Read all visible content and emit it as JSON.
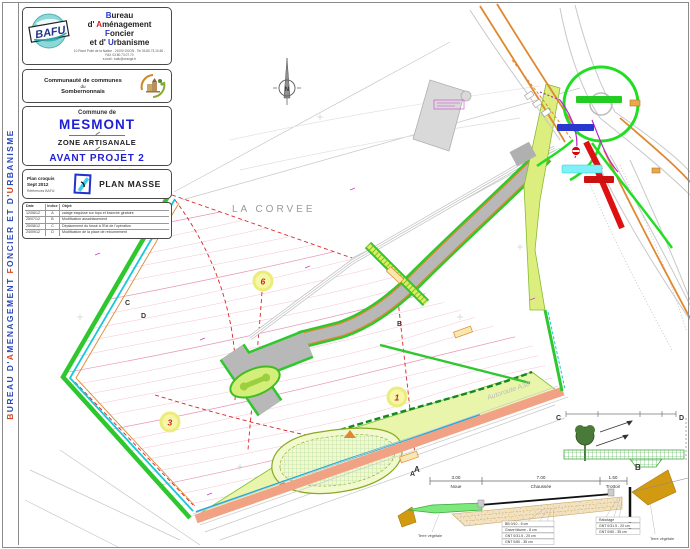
{
  "colors": {
    "brand_blue": "#2233cc",
    "accent_red": "#cc2222",
    "site_green": "#2ec82e",
    "cyan_line": "#18c8d8",
    "salmon_road": "#f2a284",
    "contour_pink": "#f2b6c6",
    "title_blue": "#1f1fd6"
  },
  "sidebar": {
    "parts": [
      {
        "t": "B",
        "c": "sr"
      },
      {
        "t": "UREAU  D'",
        "c": "sb"
      },
      {
        "t": "A",
        "c": "sr"
      },
      {
        "t": "MENAGEMENT  ",
        "c": "sb"
      },
      {
        "t": "F",
        "c": "sr"
      },
      {
        "t": "ONCIER  ET  D'",
        "c": "sb"
      },
      {
        "t": "U",
        "c": "sr"
      },
      {
        "t": "RBANISME",
        "c": "sb"
      }
    ]
  },
  "firm": {
    "logo_text": "BAFU",
    "line1": [
      {
        "t": "B",
        "c": "blue"
      },
      {
        "t": "ureau",
        "c": "k"
      }
    ],
    "line2": [
      {
        "t": "d' ",
        "c": "k"
      },
      {
        "t": "A",
        "c": "red"
      },
      {
        "t": "ménagement",
        "c": "k"
      }
    ],
    "line3": [
      {
        "t": "F",
        "c": "blue"
      },
      {
        "t": "oncier",
        "c": "k"
      }
    ],
    "line4": [
      {
        "t": "et d' ",
        "c": "k"
      },
      {
        "t": "U",
        "c": "blue"
      },
      {
        "t": "rbanisme",
        "c": "k"
      }
    ],
    "address": "10 Rond Point de la Nation - 21000 DIJON - Tel 03.80.73.10.60 - FAX 03.80.73.07.70",
    "email": "e-mail : bafu@orange.fr"
  },
  "community": {
    "l1": "Communauté de communes",
    "l2": "du",
    "l3": "Sombernonnais"
  },
  "project": {
    "commune_label": "Commune de",
    "commune_name": "MESMONT",
    "zone": "ZONE ARTISANALE",
    "phase": "AVANT PROJET 2"
  },
  "plan_info": {
    "type": "Plan croquis",
    "date": "Sept 2012",
    "refs": "Références BAFU:",
    "title": "PLAN MASSE"
  },
  "revisions": {
    "headers": [
      "Date",
      "Indice",
      "Objet:"
    ],
    "rows": [
      [
        "12/06/12",
        "A",
        "calage esquisse sur topo et branche giratoire"
      ],
      [
        "25/07/12",
        "B",
        "Modification assainissement"
      ],
      [
        "25/08/12",
        "C",
        "Déplacement du fossé à l'Est de l'opération"
      ],
      [
        "24/09/12",
        "D",
        "Modification de la place de retournement"
      ]
    ]
  },
  "map": {
    "place": "LA CORVEE",
    "north": "N",
    "autoroute": "Autoroute A38",
    "lots": [
      {
        "n": "6"
      },
      {
        "n": "1"
      },
      {
        "n": "3"
      }
    ],
    "markers": {
      "a": "A",
      "b": "B",
      "c": "C",
      "d": "D"
    }
  },
  "section_ab": {
    "left_marker": "A",
    "right_marker": "B",
    "dims": [
      {
        "v": "3.00",
        "l": "Noue"
      },
      {
        "v": "7.00",
        "l": "Chaussée"
      },
      {
        "v": "1.50",
        "l": "Trottoir"
      }
    ],
    "left_note": "Terre végétale",
    "layers": [
      "BB 0/10 - 6 cm",
      "Grave bitume - 8 cm",
      "GNT 0/31.5 - 20 cm",
      "GNT 0/60 - 35 cm"
    ],
    "right_layers": [
      "Rabotage",
      "GNT 0/31.5 - 20 cm",
      "GNT 0/60 - 35 cm"
    ],
    "right_note": "Terre végétale"
  },
  "section_cd": {
    "left_marker": "C",
    "right_marker": "D"
  }
}
